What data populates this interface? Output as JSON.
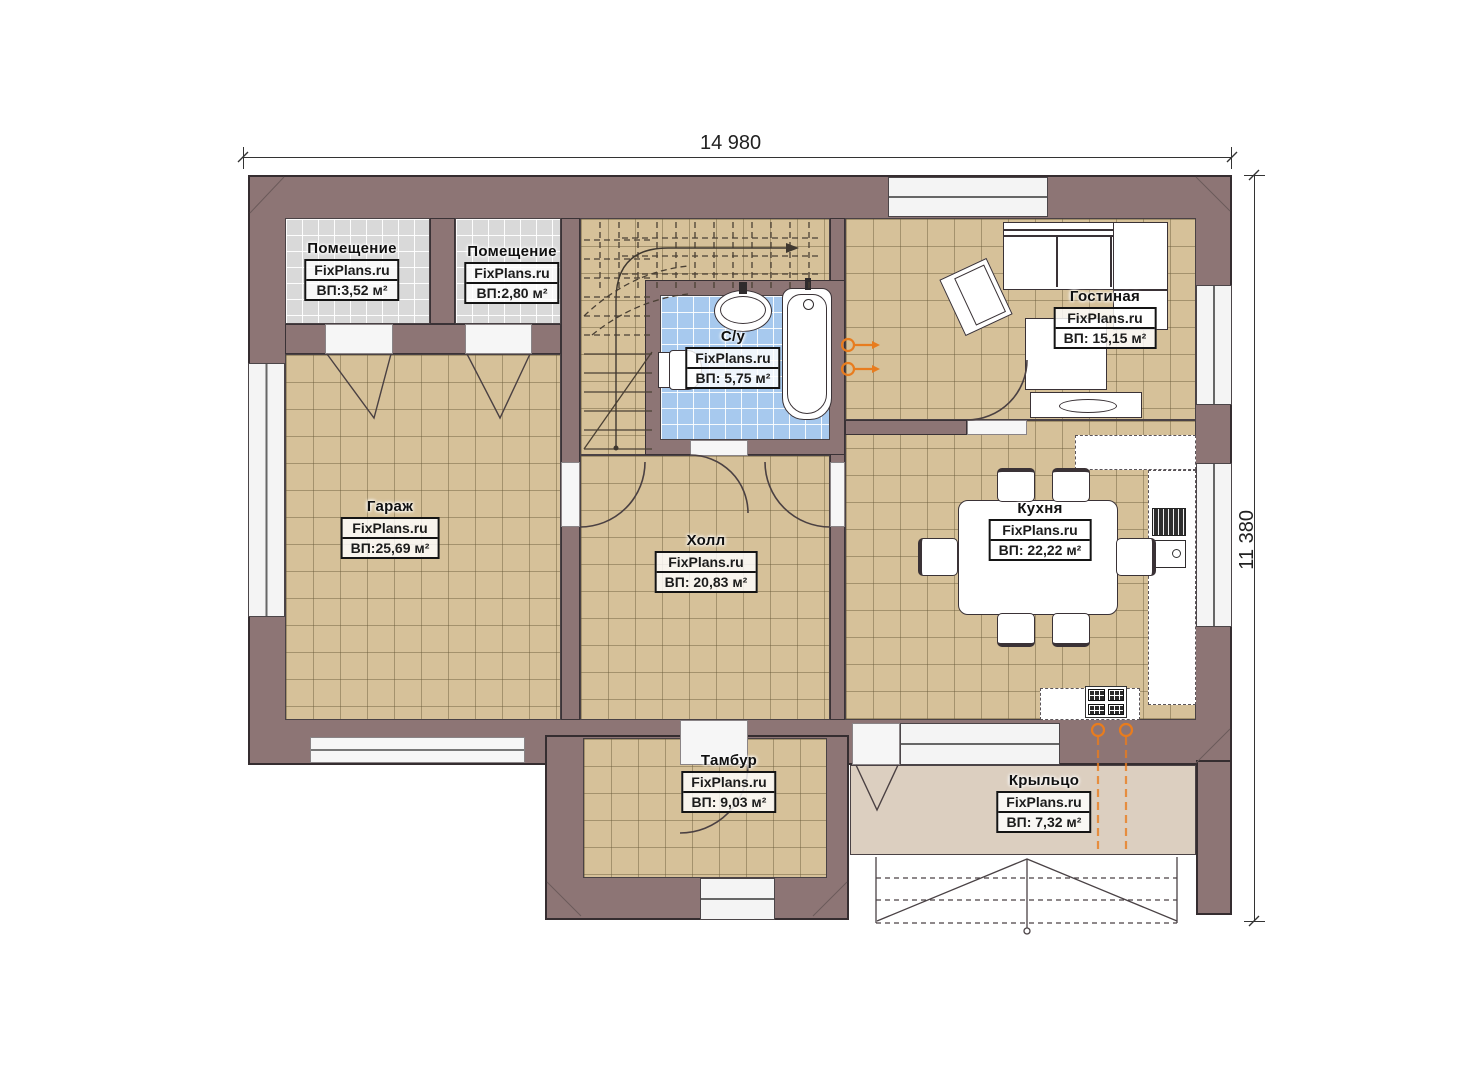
{
  "plan": {
    "type": "floor-plan",
    "dimensions": {
      "width_label": "14 980",
      "height_label": "11 380"
    },
    "watermark": "FixPlans.ru",
    "rooms": [
      {
        "name": "Помещение",
        "watermark": "FixPlans.ru",
        "area": "ВП:3,52 м²"
      },
      {
        "name": "Помещение",
        "watermark": "FixPlans.ru",
        "area": "ВП:2,80 м²"
      },
      {
        "name": "С/у",
        "watermark": "FixPlans.ru",
        "area": "ВП: 5,75 м²"
      },
      {
        "name": "Гостиная",
        "watermark": "FixPlans.ru",
        "area": "ВП: 15,15 м²"
      },
      {
        "name": "Гараж",
        "watermark": "FixPlans.ru",
        "area": "ВП:25,69 м²"
      },
      {
        "name": "Холл",
        "watermark": "FixPlans.ru",
        "area": "ВП: 20,83 м²"
      },
      {
        "name": "Кухня",
        "watermark": "FixPlans.ru",
        "area": "ВП: 22,22 м²"
      },
      {
        "name": "Тамбур",
        "watermark": "FixPlans.ru",
        "area": "ВП: 9,03 м²"
      },
      {
        "name": "Крыльцо",
        "watermark": "FixPlans.ru",
        "area": "ВП: 7,32 м²"
      }
    ],
    "colors": {
      "wall": "#8d7575",
      "floor_tile_beige": "#d6c199",
      "floor_tile_gray": "#d9d9d9",
      "floor_tile_blue": "#a7c9ee",
      "porch_floor": "#dccfc0",
      "radiator_accent": "#e87c1e"
    }
  }
}
